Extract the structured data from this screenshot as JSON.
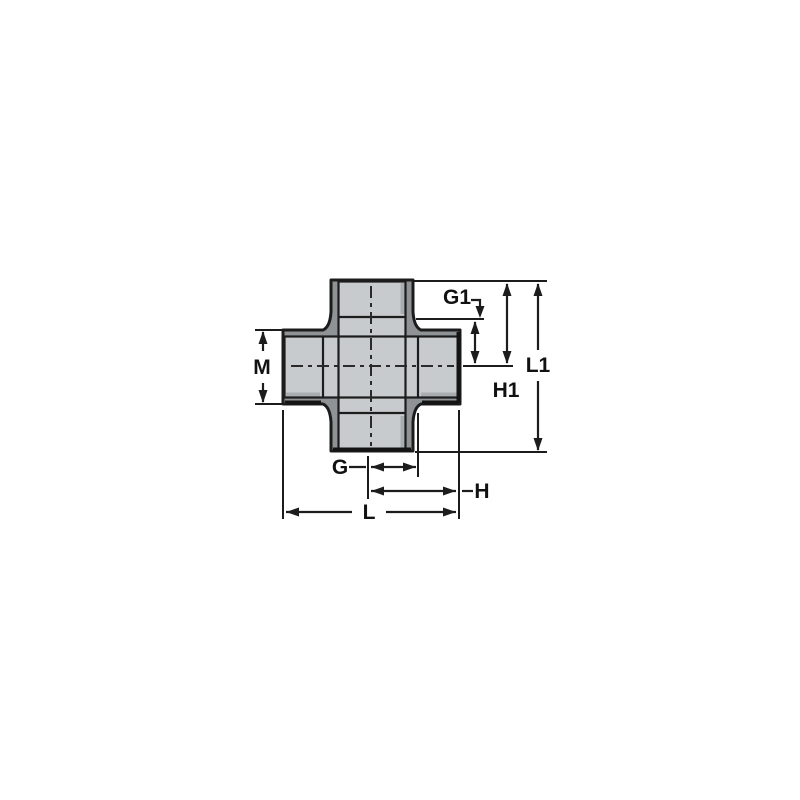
{
  "diagram": {
    "subject": "cross-fitting-dimension-drawing",
    "labels": {
      "m": "M",
      "g": "G",
      "h": "H",
      "l": "L",
      "g1": "G1",
      "h1": "H1",
      "l1": "L1"
    }
  },
  "colors": {
    "background": "#ffffff",
    "body_light": "#c7cbcd",
    "body_dark": "#8f9395",
    "outline": "#1c1c1c",
    "dim_line": "#1c1c1c",
    "shade": "#a9adaf"
  }
}
